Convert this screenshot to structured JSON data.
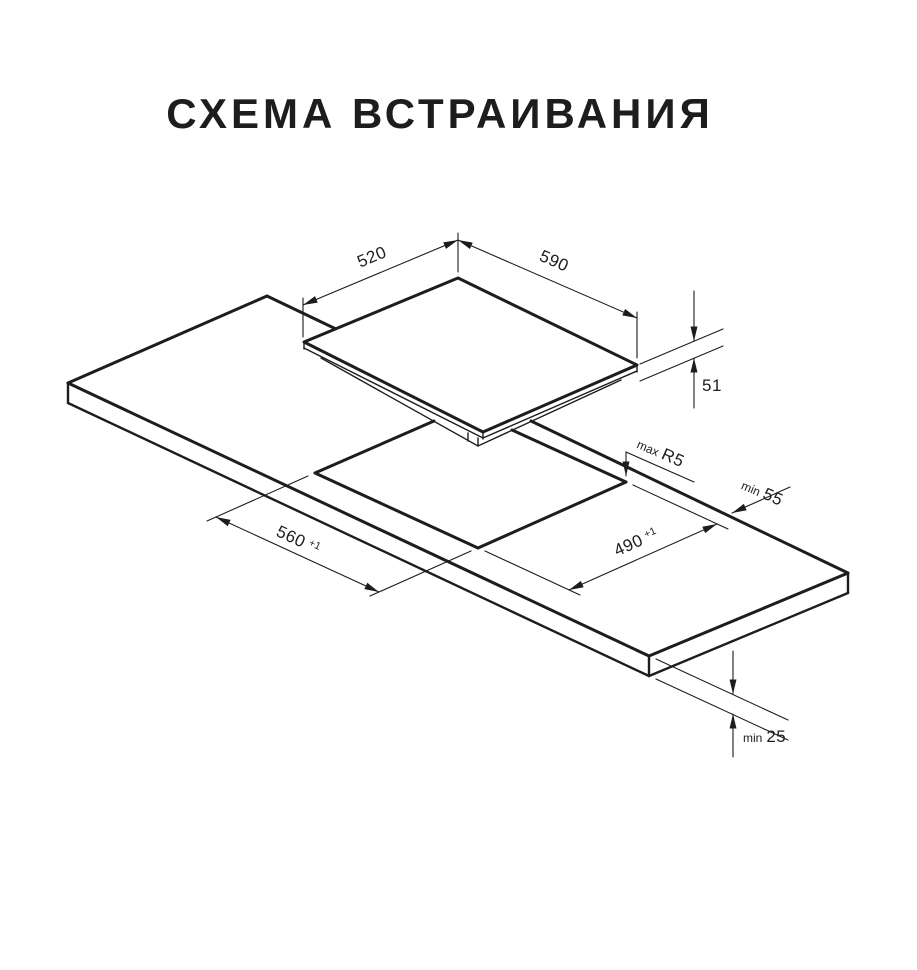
{
  "title": "СХЕМА ВСТРАИВАНИЯ",
  "labels": {
    "hob_width": "520",
    "hob_depth": "590",
    "hob_height": "51",
    "cutout_width": "560",
    "cutout_width_tol": "+1",
    "cutout_depth": "490",
    "cutout_depth_tol": "+1",
    "corner_radius_prefix": "max",
    "corner_radius": "R5",
    "edge_clearance_prefix": "min",
    "edge_clearance": "55",
    "thickness_prefix": "min",
    "thickness": "25"
  },
  "colors": {
    "line": "#1d1d1b",
    "background": "#ffffff"
  }
}
